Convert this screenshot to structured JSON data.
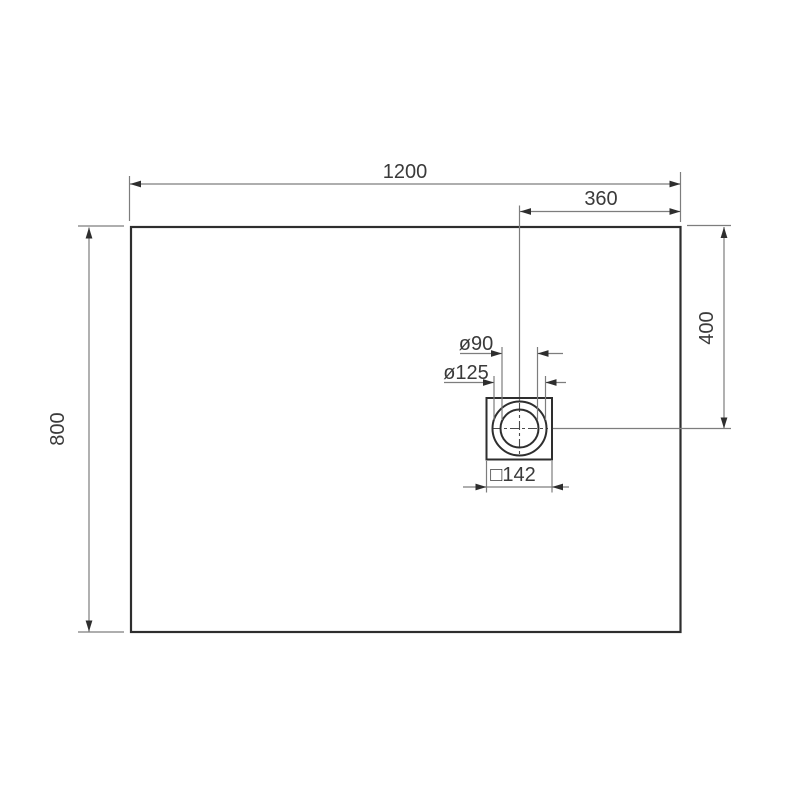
{
  "drawing": {
    "title": "shower-tray-dimension-drawing",
    "labels": {
      "overall_width": "1200",
      "overall_height": "800",
      "drain_offset_from_right": "360",
      "drain_offset_from_top": "400",
      "drain_inner_diameter": "ø90",
      "drain_outer_diameter": "ø125",
      "drain_square": "□142"
    },
    "colors": {
      "background": "#ffffff",
      "outline": "#2e2e2e",
      "dimension_line": "#7d7d7d",
      "arrowhead": "#2e2e2e",
      "text": "#3a3a3a"
    }
  }
}
